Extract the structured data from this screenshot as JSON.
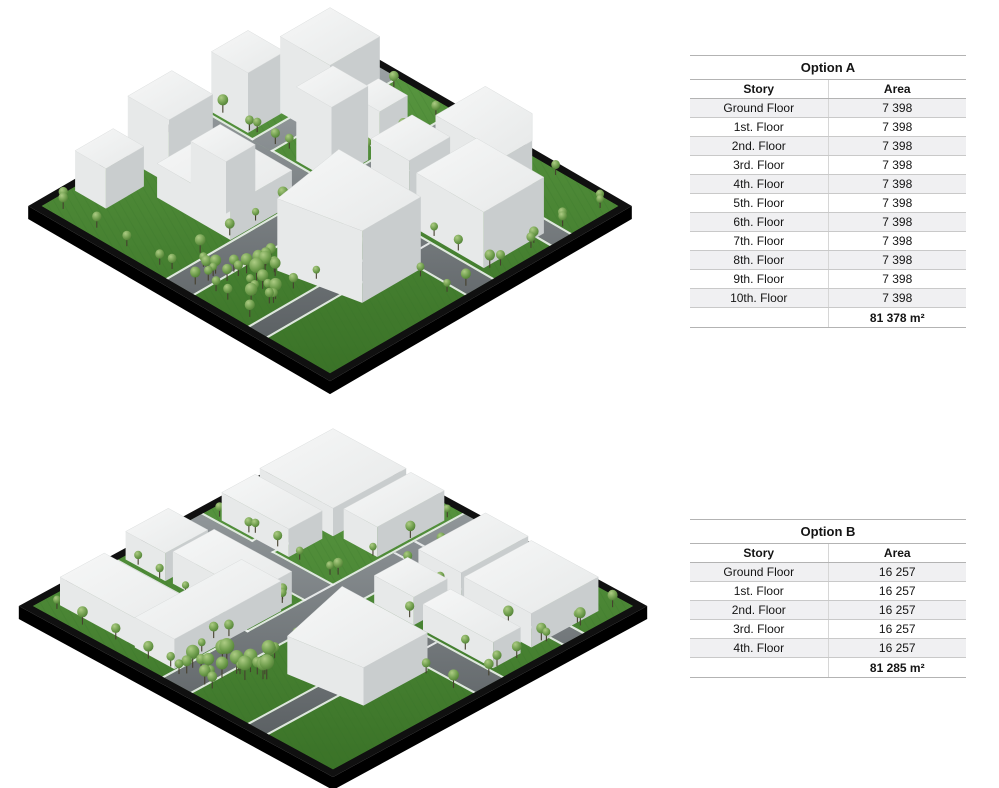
{
  "page": {
    "background": "#ffffff"
  },
  "tables": [
    {
      "title": "Option A",
      "columns": [
        "Story",
        "Area"
      ],
      "rows": [
        [
          "Ground Floor",
          "7 398"
        ],
        [
          "1st. Floor",
          "7 398"
        ],
        [
          "2nd. Floor",
          "7 398"
        ],
        [
          "3rd. Floor",
          "7 398"
        ],
        [
          "4th. Floor",
          "7 398"
        ],
        [
          "5th. Floor",
          "7 398"
        ],
        [
          "6th. Floor",
          "7 398"
        ],
        [
          "7th. Floor",
          "7 398"
        ],
        [
          "8th. Floor",
          "7 398"
        ],
        [
          "9th. Floor",
          "7 398"
        ],
        [
          "10th. Floor",
          "7 398"
        ]
      ],
      "total": "81 378 m²",
      "pos": {
        "left": 690,
        "top": 55
      }
    },
    {
      "title": "Option B",
      "columns": [
        "Story",
        "Area"
      ],
      "rows": [
        [
          "Ground Floor",
          "16 257"
        ],
        [
          "1st. Floor",
          "16 257"
        ],
        [
          "2nd. Floor",
          "16 257"
        ],
        [
          "3rd. Floor",
          "16 257"
        ],
        [
          "4th. Floor",
          "16 257"
        ]
      ],
      "total": "81 285 m²",
      "pos": {
        "left": 690,
        "top": 519
      }
    }
  ],
  "colors": {
    "base_top": "#101010",
    "base_side": "#000000",
    "grass_light": "#5b9a42",
    "grass_dark": "#3a7227",
    "grass_stripe": "#2f6b22",
    "road_light": "#a2a8ab",
    "road_dark": "#53585b",
    "road_edge": "#f0f2f2",
    "roof_light": "#f6f7f7",
    "roof_dark": "#e7e9e9",
    "face_light": "#e7e9e9",
    "face_mid": "#d8dbdb",
    "face_dark": "#c9cdce",
    "roof_stroke": "#d3d6d6",
    "tree_light": "#adcc84",
    "tree_mid": "#6d9c4b",
    "tree_dark": "#426f2b",
    "trunk": "#45402e"
  },
  "scenes": [
    {
      "name": "option-a-massing-model",
      "frame": {
        "left": 10,
        "top": 0,
        "width": 645,
        "height": 402
      },
      "cx": 320,
      "topY": 36,
      "w2": 293,
      "h2": 170,
      "base": 13,
      "roads": [
        [
          "u",
          0.44,
          0.525,
          0,
          1
        ],
        [
          "v",
          0.44,
          0.525,
          0,
          1
        ],
        [
          "v",
          0.72,
          0.775,
          0.44,
          1
        ],
        [
          "u",
          0.175,
          0.235,
          0.44,
          1
        ],
        [
          "v",
          0.175,
          0.235,
          0,
          0.44
        ]
      ],
      "buildings": [
        {
          "b": [
            0.14,
            0.14,
            0.31,
            0.31
          ],
          "h": 76
        },
        {
          "b": [
            0.325,
            0.16,
            0.425,
            0.255
          ],
          "h": 40
        },
        {
          "b": [
            0.31,
            0.3,
            0.43,
            0.425
          ],
          "h": 74
        },
        {
          "b": [
            0.02,
            0.3,
            0.145,
            0.425
          ],
          "h": 60
        },
        {
          "b": [
            0.02,
            0.56,
            0.16,
            0.71
          ],
          "h": 64
        },
        {
          "b": [
            0.02,
            0.76,
            0.125,
            0.89
          ],
          "h": 40
        },
        {
          "b": [
            0.18,
            0.56,
            0.43,
            0.77
          ],
          "h": 34,
          "stack": {
            "b": [
              0.225,
              0.6,
              0.345,
              0.7
            ],
            "h": 52
          }
        },
        {
          "b": [
            0.56,
            0.28,
            0.69,
            0.42
          ],
          "h": 64
        },
        {
          "b": [
            0.715,
            0.215,
            0.945,
            0.42
          ],
          "h": 56
        },
        {
          "p": [
            [
              0.56,
              0.03
            ],
            [
              0.72,
              0.03
            ],
            [
              0.8,
              0.11
            ],
            [
              0.8,
              0.2
            ],
            [
              0.56,
              0.2
            ]
          ],
          "h": 50
        },
        {
          "p": [
            [
              0.56,
              0.53
            ],
            [
              0.84,
              0.53
            ],
            [
              0.84,
              0.73
            ],
            [
              0.6,
              0.78
            ]
          ],
          "h": 72
        }
      ],
      "treeRows": [
        [
          0.05,
          0.415,
          0.4,
          0.415,
          5,
          1
        ],
        [
          0.57,
          0.415,
          0.95,
          0.415,
          5,
          1
        ],
        [
          0.05,
          0.555,
          0.4,
          0.555,
          5,
          1
        ],
        [
          0.57,
          0.555,
          0.95,
          0.555,
          5,
          1
        ],
        [
          0.415,
          0.05,
          0.415,
          0.4,
          4,
          1
        ],
        [
          0.415,
          0.57,
          0.415,
          0.95,
          5,
          1
        ],
        [
          0.555,
          0.05,
          0.555,
          0.4,
          4,
          1
        ],
        [
          0.555,
          0.57,
          0.555,
          0.95,
          5,
          1
        ],
        [
          0.6,
          0.56,
          0.6,
          0.95,
          6,
          1
        ],
        [
          0.685,
          0.5,
          0.685,
          0.96,
          7,
          1
        ],
        [
          0.5,
          0.155,
          0.95,
          0.155,
          6,
          1
        ],
        [
          0.5,
          0.26,
          0.95,
          0.26,
          6,
          1
        ],
        [
          0.155,
          0.05,
          0.155,
          0.4,
          4,
          1
        ],
        [
          0.265,
          0.05,
          0.265,
          0.4,
          4,
          1
        ],
        [
          0.05,
          0.96,
          0.5,
          0.96,
          5,
          1
        ],
        [
          0.96,
          0.05,
          0.96,
          0.5,
          5,
          1
        ],
        [
          0.03,
          0.5,
          0.03,
          0.95,
          4,
          1
        ],
        [
          0.5,
          0.03,
          0.95,
          0.03,
          4,
          1
        ]
      ],
      "treeClusters": [
        [
          0.58,
          0.84,
          0.075,
          9,
          1.3
        ],
        [
          0.5,
          0.91,
          0.05,
          6,
          1.1
        ],
        [
          0.66,
          0.9,
          0.05,
          5,
          1.2
        ]
      ]
    },
    {
      "name": "option-b-massing-model",
      "frame": {
        "left": 8,
        "top": 422,
        "width": 656,
        "height": 366
      },
      "cx": 325,
      "topY": 18,
      "w2": 305,
      "h2": 166,
      "base": 13,
      "roads": [
        [
          "u",
          0.44,
          0.525,
          0,
          1
        ],
        [
          "v",
          0.44,
          0.525,
          0,
          1
        ],
        [
          "v",
          0.72,
          0.775,
          0.44,
          1
        ],
        [
          "u",
          0.175,
          0.235,
          0.44,
          1
        ],
        [
          "v",
          0.175,
          0.235,
          0,
          0.44
        ],
        [
          "u",
          0.72,
          0.775,
          0,
          0.44
        ]
      ],
      "buildings": [
        {
          "b": [
            0.05,
            0.05,
            0.29,
            0.29
          ],
          "h": 28
        },
        {
          "b": [
            0.315,
            0.06,
            0.425,
            0.28
          ],
          "h": 30
        },
        {
          "b": [
            0.06,
            0.315,
            0.28,
            0.425
          ],
          "h": 28
        },
        {
          "b": [
            0.02,
            0.56,
            0.15,
            0.7
          ],
          "h": 28
        },
        {
          "b": [
            0.17,
            0.56,
            0.425,
            0.695
          ],
          "h": 32
        },
        {
          "b": [
            0.05,
            0.8,
            0.4,
            0.945
          ],
          "h": 28
        },
        {
          "b": [
            0.56,
            0.06,
            0.7,
            0.28
          ],
          "h": 30
        },
        {
          "b": [
            0.73,
            0.08,
            0.95,
            0.3
          ],
          "h": 34
        },
        {
          "b": [
            0.56,
            0.315,
            0.69,
            0.425
          ],
          "h": 28
        },
        {
          "p": [
            [
              0.57,
              0.54
            ],
            [
              0.85,
              0.54
            ],
            [
              0.85,
              0.75
            ],
            [
              0.63,
              0.78
            ]
          ],
          "h": 38
        },
        {
          "b": [
            0.3,
            0.6,
            0.43,
            0.95
          ],
          "h": 30
        },
        {
          "b": [
            0.72,
            0.335,
            0.95,
            0.425
          ],
          "h": 26
        }
      ],
      "treeRows": [
        [
          0.05,
          0.415,
          0.4,
          0.415,
          5,
          1
        ],
        [
          0.57,
          0.415,
          0.95,
          0.415,
          5,
          1
        ],
        [
          0.05,
          0.555,
          0.4,
          0.555,
          5,
          1
        ],
        [
          0.57,
          0.555,
          0.95,
          0.555,
          5,
          1
        ],
        [
          0.415,
          0.05,
          0.415,
          0.4,
          4,
          1
        ],
        [
          0.415,
          0.57,
          0.415,
          0.95,
          5,
          1
        ],
        [
          0.555,
          0.05,
          0.555,
          0.4,
          4,
          1
        ],
        [
          0.555,
          0.57,
          0.555,
          0.95,
          5,
          1
        ],
        [
          0.5,
          0.155,
          0.95,
          0.155,
          5,
          1
        ],
        [
          0.5,
          0.265,
          0.95,
          0.265,
          5,
          1
        ],
        [
          0.155,
          0.05,
          0.155,
          0.4,
          4,
          1
        ],
        [
          0.05,
          0.7,
          0.4,
          0.7,
          5,
          1
        ],
        [
          0.05,
          0.79,
          0.4,
          0.79,
          5,
          1
        ],
        [
          0.05,
          0.96,
          0.45,
          0.96,
          5,
          1
        ],
        [
          0.96,
          0.05,
          0.96,
          0.45,
          5,
          1
        ]
      ],
      "treeClusters": [
        [
          0.55,
          0.82,
          0.08,
          12,
          1.4
        ],
        [
          0.5,
          0.92,
          0.05,
          7,
          1.2
        ]
      ]
    }
  ]
}
